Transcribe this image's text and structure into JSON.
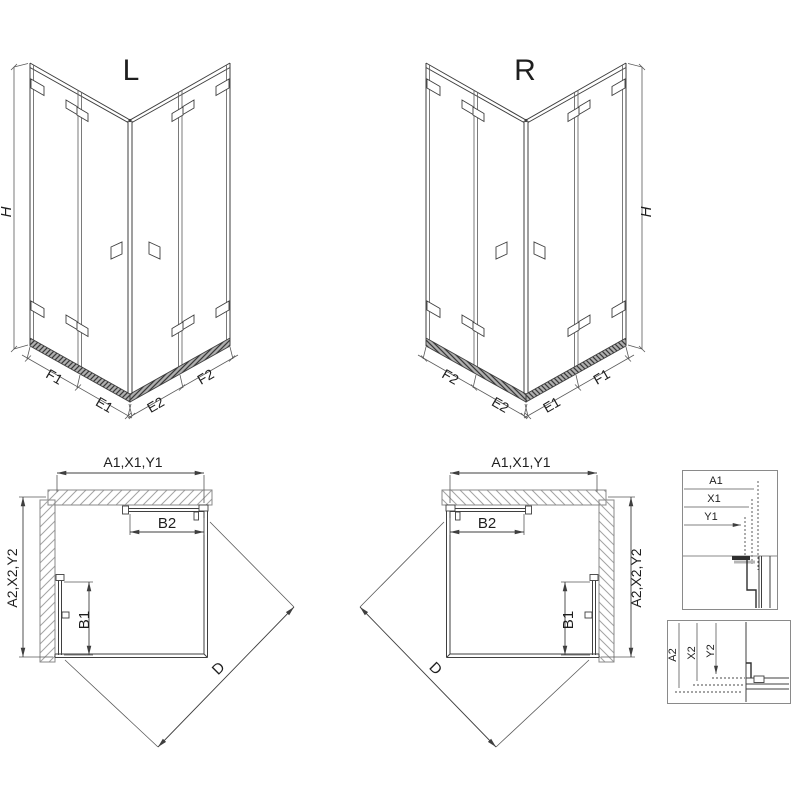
{
  "drawing": {
    "iso_left": {
      "title": "L",
      "height_label": "H",
      "segments": [
        "F1",
        "E1",
        "E2",
        "F2"
      ]
    },
    "iso_right": {
      "title": "R",
      "height_label": "H",
      "segments": [
        "F2",
        "E2",
        "E1",
        "F1"
      ]
    },
    "plan_left": {
      "width_label": "A1,X1,Y1",
      "depth_label": "A2,X2,Y2",
      "door_top_label": "B2",
      "door_side_label": "B1",
      "diagonal_label": "D"
    },
    "plan_right": {
      "width_label": "A1,X1,Y1",
      "depth_label": "A2,X2,Y2",
      "door_top_label": "B2",
      "door_side_label": "B1",
      "diagonal_label": "D"
    },
    "detail_width": {
      "labels": [
        "A1",
        "X1",
        "Y1"
      ]
    },
    "detail_depth": {
      "labels": [
        "A2",
        "X2",
        "Y2"
      ]
    },
    "colors": {
      "line": "#3f3f3f",
      "wall_outline": "#8a8a8a",
      "hatch": "#a3a3a3",
      "rail_fill": "#b0b0b0",
      "rail_hatch": "#3a3a3a",
      "background": "#ffffff",
      "text": "#1e1e1e"
    }
  }
}
